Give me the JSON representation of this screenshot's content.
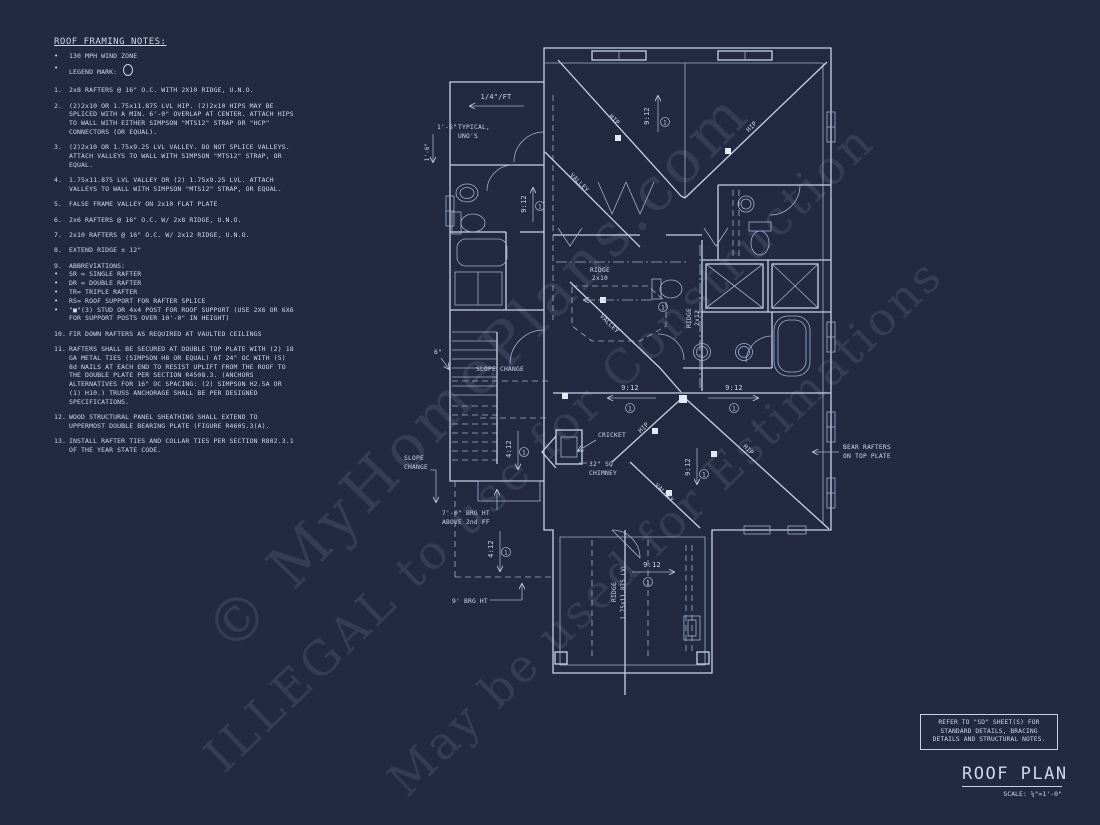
{
  "sheet": {
    "title": "ROOF PLAN",
    "scale": "SCALE: ¼\"=1'-0\"",
    "background": "#222940",
    "line_color": "#c6d2e8"
  },
  "watermarks": {
    "line1": "© MyHomePlans.com",
    "line2": "ILLEGAL to use for Construction",
    "line3": "May be used for Estimations"
  },
  "ref_note": {
    "line1": "REFER TO \"SD\"  SHEET(S) FOR",
    "line2": "STANDARD DETAILS, BRACING",
    "line3": "DETAILS AND STRUCTURAL NOTES."
  },
  "notes": {
    "title": "ROOF FRAMING NOTES:",
    "bullet1": "130 MPH WIND ZONE",
    "bullet2": "LEGEND MARK:",
    "items": [
      {
        "n": "1.",
        "text": "2x8 RAFTERS @ 16\" O.C. WITH 2X10 RIDGE, U.N.O."
      },
      {
        "n": "2.",
        "text": "(2)2x10 OR 1.75x11.875 LVL HIP.  (2)2x10 HIPS MAY BE SPLICED WITH A MIN. 6'-0\" OVERLAP AT CENTER. ATTACH HIPS TO WALL WITH EITHER SIMPSON \"MTS12\" STRAP OR \"HCP\" CONNECTORS (OR EQUAL)."
      },
      {
        "n": "3.",
        "text": "(2)2x10 OR 1.75x9.25 LVL VALLEY.  DO NOT SPLICE VALLEYS. ATTACH VALLEYS TO WALL WITH  SIMPSON \"MTS12\" STRAP, OR EQUAL."
      },
      {
        "n": "4.",
        "text": "1.75x11.875 LVL VALLEY OR (2) 1.75x9.25 LVL.  ATTACH VALLEYS TO WALL WITH SIMPSON \"MTS12\" STRAP, OR EQUAL."
      },
      {
        "n": "5.",
        "text": "FALSE FRAME VALLEY ON 2x10 FLAT PLATE"
      },
      {
        "n": "6.",
        "text": "2x6 RAFTERS @ 16\" O.C. W/ 2x8 RIDGE, U.N.O."
      },
      {
        "n": "7.",
        "text": "2x10 RAFTERS @ 16\" O.C. W/ 2x12 RIDGE, U.N.O."
      },
      {
        "n": "8.",
        "text": "EXTEND RIDGE ± 12\""
      },
      {
        "n": "9.",
        "text": "ABBREVIATIONS:",
        "subs": [
          "SR = SINGLE RAFTER",
          "DR = DOUBLE RAFTER",
          "TR= TRIPLE RAFTER",
          "RS= ROOF SUPPORT FOR RAFTER SPLICE",
          "\"■\"(3) STUD OR 4x4 POST FOR ROOF SUPPORT (USE 2X6 OR 6X6 FOR SUPPORT POSTS OVER 10'-0\" IN HEIGHT)"
        ]
      },
      {
        "n": "10.",
        "text": "FIR DOWN RAFTERS AS REQUIRED AT VAULTED CEILINGS"
      },
      {
        "n": "11.",
        "text": "RAFTERS SHALL BE SECURED AT DOUBLE TOP PLATE WITH (2) 18 GA METAL TIES (SIMPSON H8 OR EQUAL) AT 24\" OC WITH (5) 8d NAILS AT EACH END TO RESIST UPLIFT FROM THE ROOF TO THE DOUBLE PLATE PER SECTION R4508.3. (ANCHORS ALTERNATIVES FOR 16\" OC SPACING: (2) SIMPSON H2.5A OR (1) H10.) TRUSS ANCHORAGE SHALL BE PER DESIGNED SPECIFICATIONS."
      },
      {
        "n": "12.",
        "text": "WOOD STRUCTURAL PANEL SHEATHING SHALL EXTEND TO UPPERMOST DOUBLE BEARING PLATE (FIGURE R4605.3(A)."
      },
      {
        "n": "13.",
        "text": "INSTALL RAFTER TIES AND COLLAR TIES PER SECTION R802.3.1 OF THE YEAR STATE CODE."
      }
    ]
  },
  "plan": {
    "pitch_per_ft": "1/4\"/FT",
    "dim_1_6": "1'-6\"",
    "typical_line1": "TYPICAL,",
    "typical_line2": "UNO'S",
    "dim_6": "6\"",
    "slope_912": "9:12",
    "slope_412": "4:12",
    "hip": "HIP",
    "valley": "VALLEY",
    "ridge": "RIDGE",
    "ridge_2x10": "2x10",
    "ridge_2x12": "2x12",
    "ridge_lvl": "1.75x11.875 LVL",
    "slope_change": "SLOPE CHANGE",
    "slope_change_l1": "SLOPE",
    "slope_change_l2": "CHANGE",
    "cricket": "CRICKET",
    "chimney_l1": "32\" SQ",
    "chimney_l2": "CHIMNEY",
    "brg7_l1": "7'-0\" BRG HT",
    "brg7_l2": "ABOVE 2nd FF",
    "brg9": "9' BRG HT",
    "bear_l1": "BEAR RAFTERS",
    "bear_l2": "ON TOP PLATE",
    "legend_mark": "1"
  }
}
